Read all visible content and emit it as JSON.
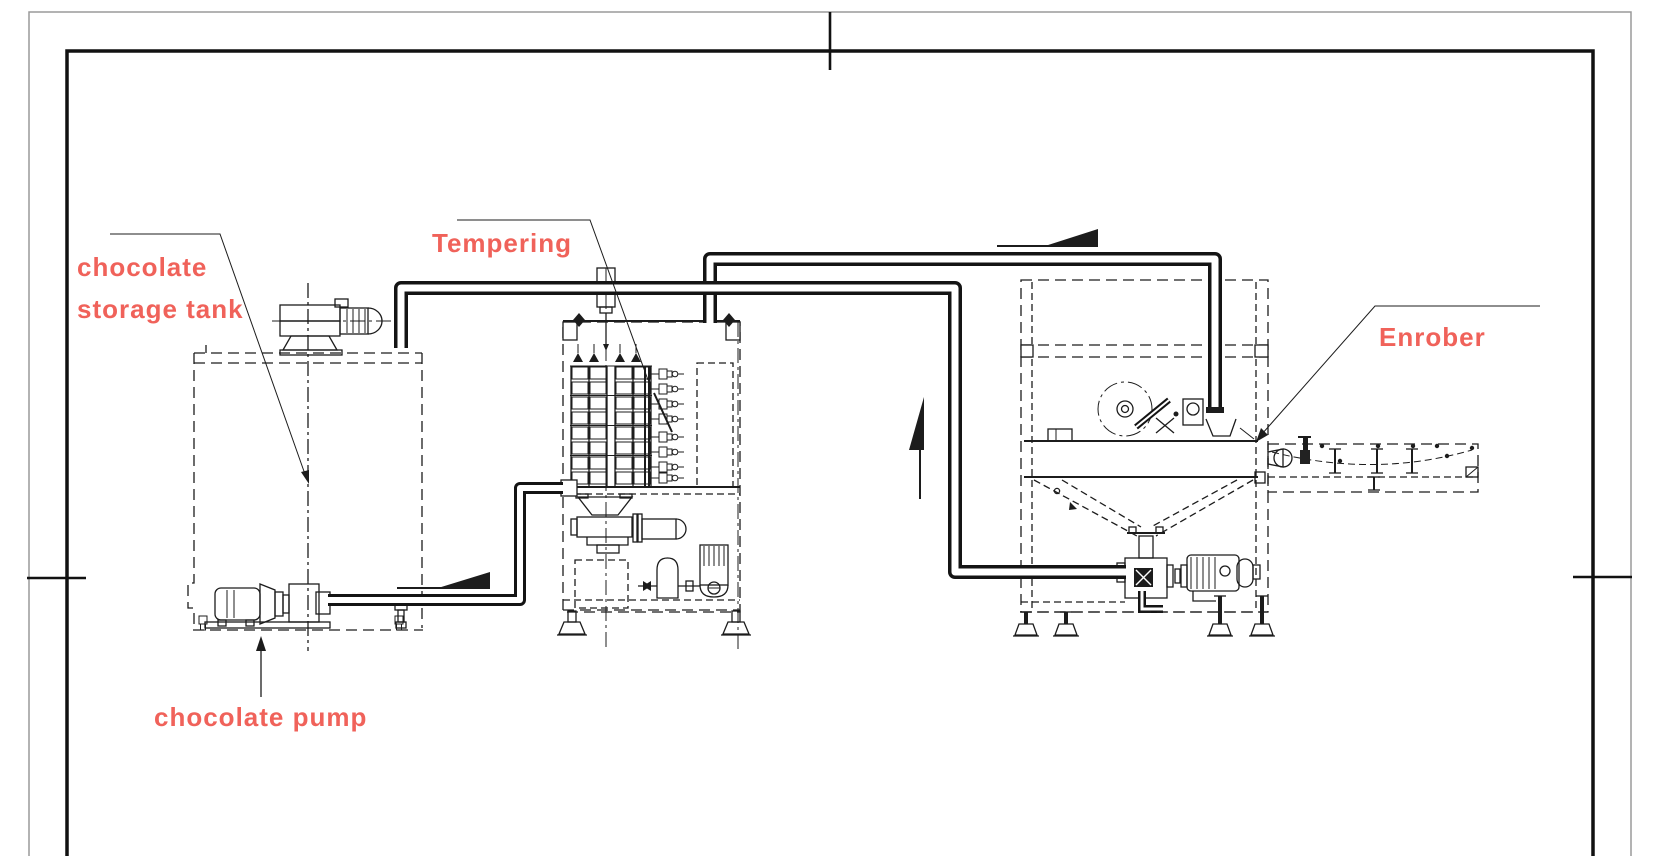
{
  "colors": {
    "label": "#f0625a",
    "line": "#1c1c1c",
    "background": "#ffffff"
  },
  "labels": {
    "storage_tank_line1": "chocolate",
    "storage_tank_line2": "storage tank",
    "tempering": "Tempering",
    "enrober": "Enrober",
    "chocolate_pump": "chocolate pump"
  },
  "flow_arrows": [
    {
      "name": "tank-pump-discharge",
      "direction": "right"
    },
    {
      "name": "tempering-to-enrober",
      "direction": "right"
    },
    {
      "name": "enrober-return-riser",
      "direction": "up"
    }
  ]
}
